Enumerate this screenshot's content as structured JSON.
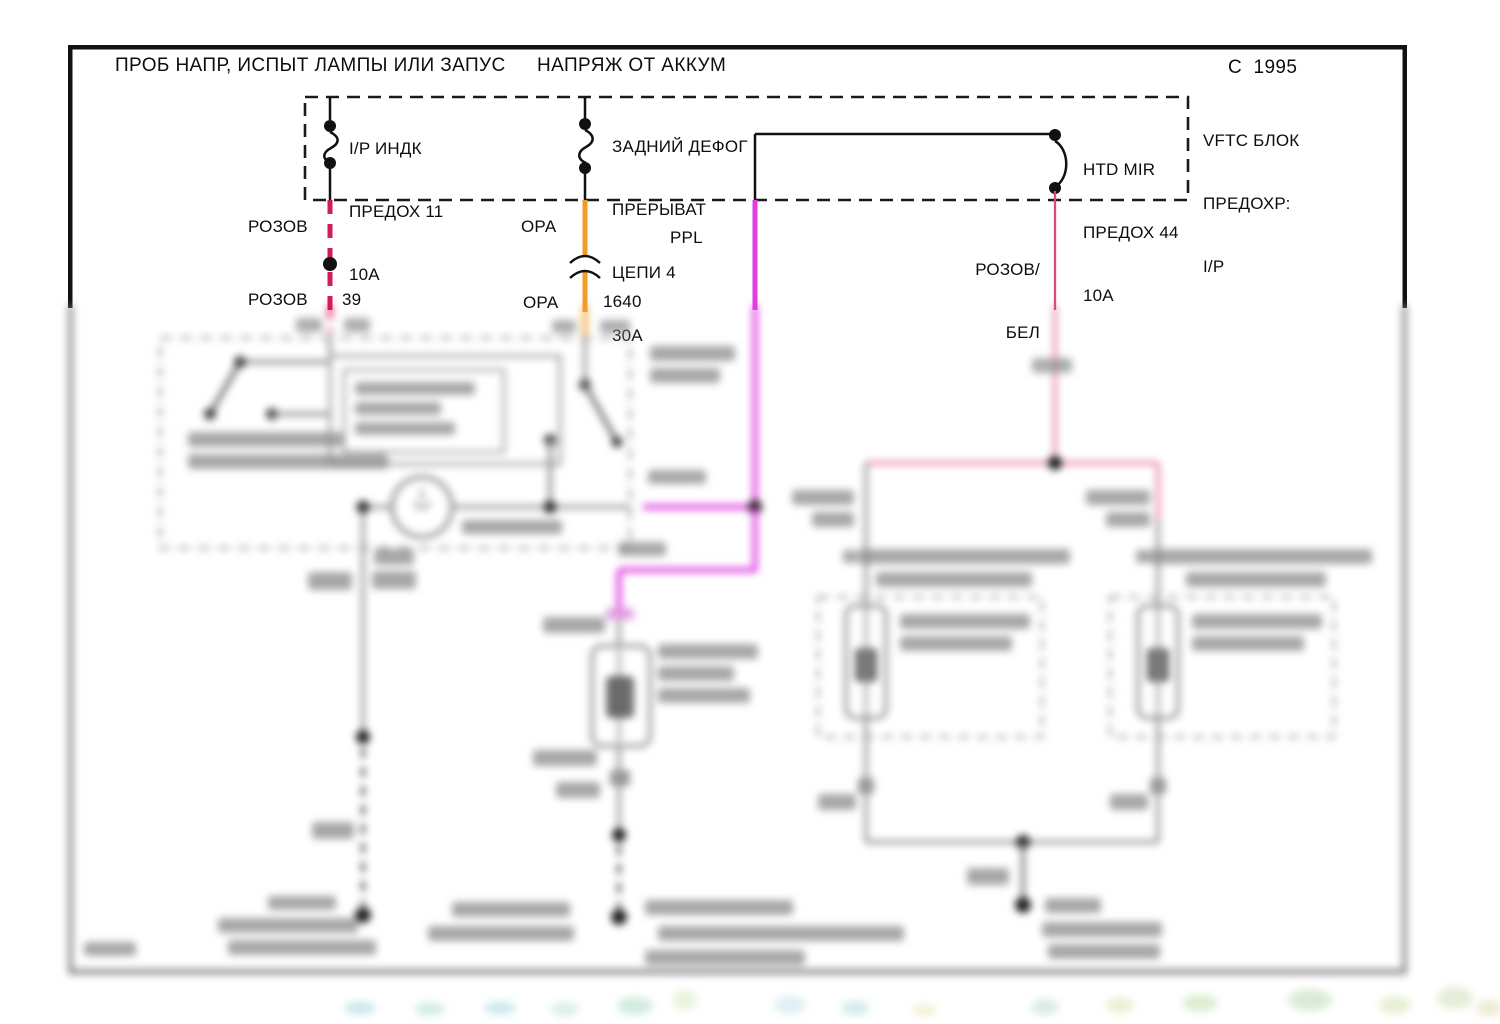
{
  "page": {
    "title_left": "ПРОБ НАПР, ИСПЫТ ЛАМПЫ ИЛИ ЗАПУС",
    "title_right": "НАПРЯЖ ОТ АККУМ",
    "copyright": "C  1995"
  },
  "fuse_panel": {
    "name_lines": [
      "VFTC БЛОК",
      "ПРЕДОХР:",
      "I/P"
    ],
    "fuses": [
      {
        "lines": [
          "I/P ИНДК",
          "ПРЕДОХ 11",
          "10A"
        ]
      },
      {
        "lines": [
          "ЗАДНИЙ ДЕФОГ",
          "ПРЕРЫВАТ",
          "ЦЕПИ 4",
          "30A"
        ]
      },
      {
        "lines": [
          "HTD MIR",
          "ПРЕДОХ 44",
          "10A"
        ]
      }
    ]
  },
  "wires": {
    "pink": {
      "label": "РОЗОВ",
      "label_lower": "РОЗОВ",
      "circuit": "39",
      "color": "#d41a5e"
    },
    "orange": {
      "label": "ОРА",
      "label_lower": "ОРА",
      "circuit": "1640",
      "color": "#f09d28"
    },
    "purple": {
      "label": "PPL",
      "color": "#e03ee0"
    },
    "pink_white": {
      "label_line1": "РОЗОВ/",
      "label_line2": "БЕЛ",
      "color": "#d84b7d"
    }
  }
}
